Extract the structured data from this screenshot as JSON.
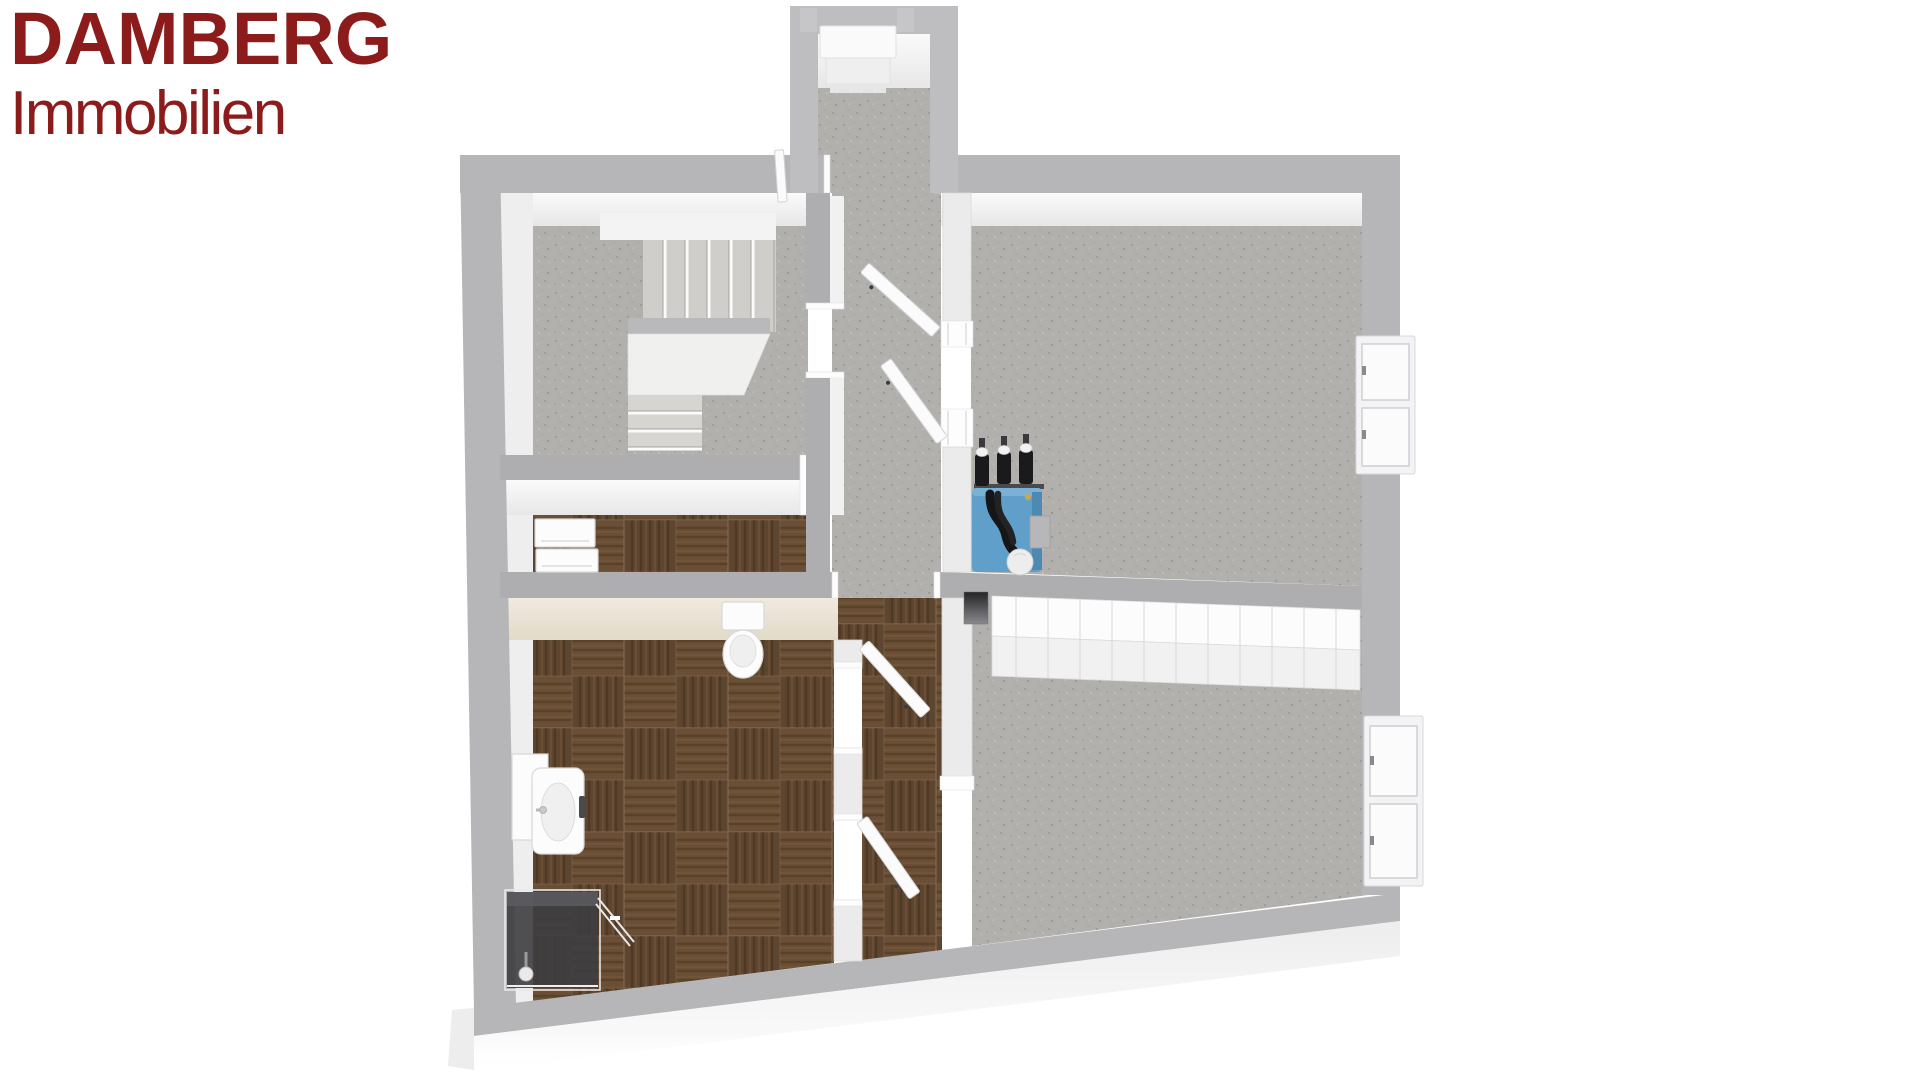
{
  "page": {
    "background": "#ffffff",
    "kind": "real-estate 3D floor plan rendering (bird's-eye view), no room labels or dimension text visible"
  },
  "logo": {
    "line1": "DAMBERG",
    "line2": "Immobilien",
    "color": "#8c1b1b"
  },
  "floor_plan": {
    "colors": {
      "page_bg": "#ffffff",
      "logo_color": "#8c1b1b",
      "wall_top": "#b6b6b8",
      "wall_top_interior": "#aeaeb0",
      "wall_top_vestibule": "#bebec0",
      "wall_face": "#f5f5f6",
      "wall_face_beige": "#ece5d8",
      "floor_concrete": "#b2b0ad",
      "floor_concrete_speckle": "#9d9b97",
      "floor_wood_dark": "#5e452f",
      "floor_wood_light": "#6a4f36",
      "cabinet_white": "#f1f1f2",
      "boiler_blue": "#5f9fc9",
      "pipe_black": "#1a1a1c",
      "shower_glass_dark": "#3d3d40",
      "plinth_white": "#efeff0"
    },
    "elements": [
      {
        "name": "entry-vestibule",
        "floor": "concrete",
        "fixtures": [
          "entry-door-slab",
          "entry-step",
          "door-posts"
        ]
      },
      {
        "name": "staircase-room",
        "floor": "concrete",
        "fixtures": [
          "switchback-staircase-with-winder"
        ]
      },
      {
        "name": "storage-room",
        "floor": "wood-tile",
        "fixtures": [
          "white-appliance-box",
          "white-appliance-box"
        ]
      },
      {
        "name": "main-room-southwest",
        "floor": "wood-tile-checkerboard",
        "fixtures": [
          "wall-hung-toilet",
          "washbasin-vanity",
          "corner-shower-dark-glass"
        ]
      },
      {
        "name": "hallway",
        "floor": "concrete",
        "fixtures": [
          "door-leaf",
          "door-leaf",
          "door-leaf",
          "door-leaf",
          "door-leaf"
        ]
      },
      {
        "name": "utility-room-northeast",
        "floor": "concrete",
        "fixtures": [
          "blue-heating-unit",
          "black-valves",
          "black-pipes",
          "expansion-cylinder"
        ]
      },
      {
        "name": "room-southeast",
        "floor": "concrete",
        "fixtures": [
          "built-in-cabinet-row",
          "chimney-flue"
        ]
      },
      {
        "name": "corridor",
        "floor": "wood-tile",
        "fixtures": []
      },
      {
        "name": "east-wall-windows",
        "count": 2
      }
    ]
  }
}
